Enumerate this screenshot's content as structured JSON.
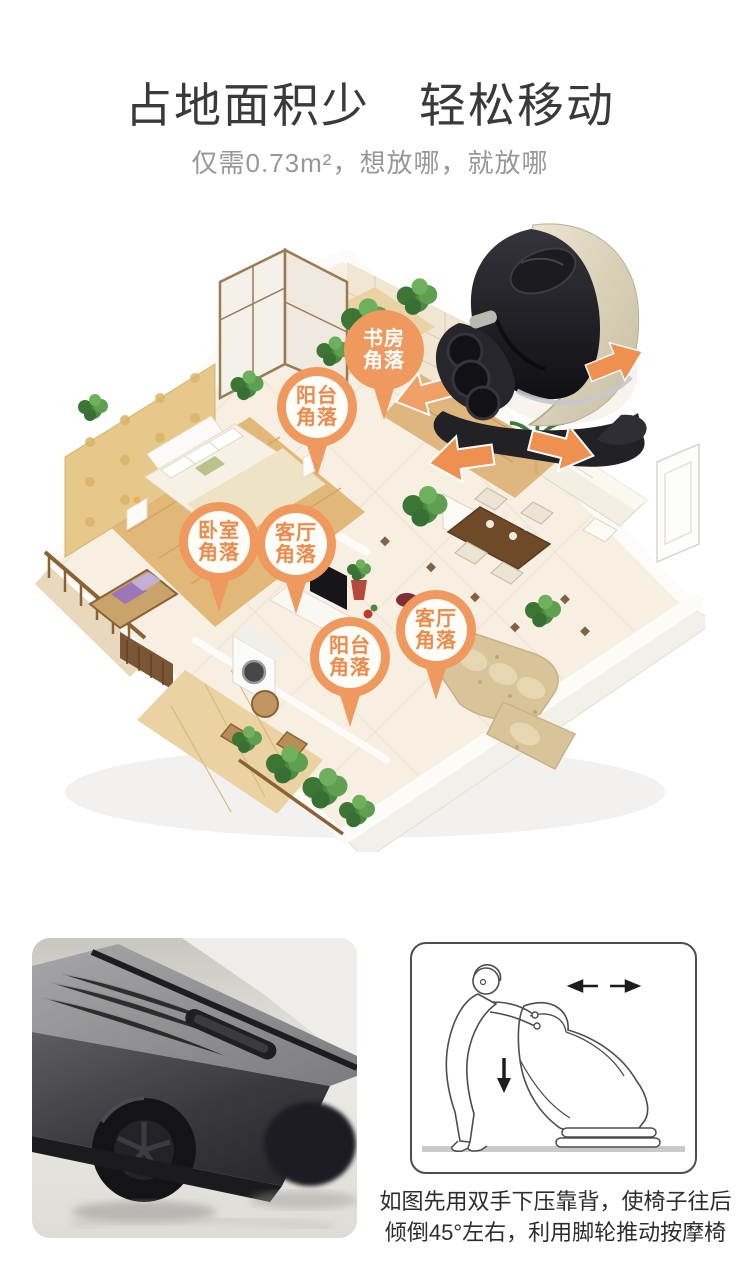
{
  "header": {
    "title": "占地面积少　轻松移动",
    "subtitle": "仅需0.73m²，想放哪，就放哪"
  },
  "scene": {
    "pins": [
      {
        "name": "study-corner",
        "line1": "书房",
        "line2": "角落",
        "style": "solid"
      },
      {
        "name": "balcony-corner-upper",
        "line1": "阳台",
        "line2": "角落",
        "style": "ring"
      },
      {
        "name": "bedroom-corner",
        "line1": "卧室",
        "line2": "角落",
        "style": "ring"
      },
      {
        "name": "living-room-corner-left",
        "line1": "客厅",
        "line2": "角落",
        "style": "ring"
      },
      {
        "name": "balcony-corner-lower",
        "line1": "阳台",
        "line2": "角落",
        "style": "ring"
      },
      {
        "name": "living-room-corner-right",
        "line1": "客厅",
        "line2": "角落",
        "style": "ring"
      }
    ],
    "arrows": [
      {
        "direction": "right-up"
      },
      {
        "direction": "left-down"
      },
      {
        "direction": "left"
      },
      {
        "direction": "right-down"
      }
    ],
    "colors": {
      "pin_orange": "#f0995f",
      "arrow_orange": "#ee9150",
      "pin_text_orange": "#ec8a4c"
    }
  },
  "instructions": {
    "line1": "如图先用双手下压靠背，使椅子往后",
    "line2": "倾倒45°左右，利用脚轮推动按摩椅"
  }
}
